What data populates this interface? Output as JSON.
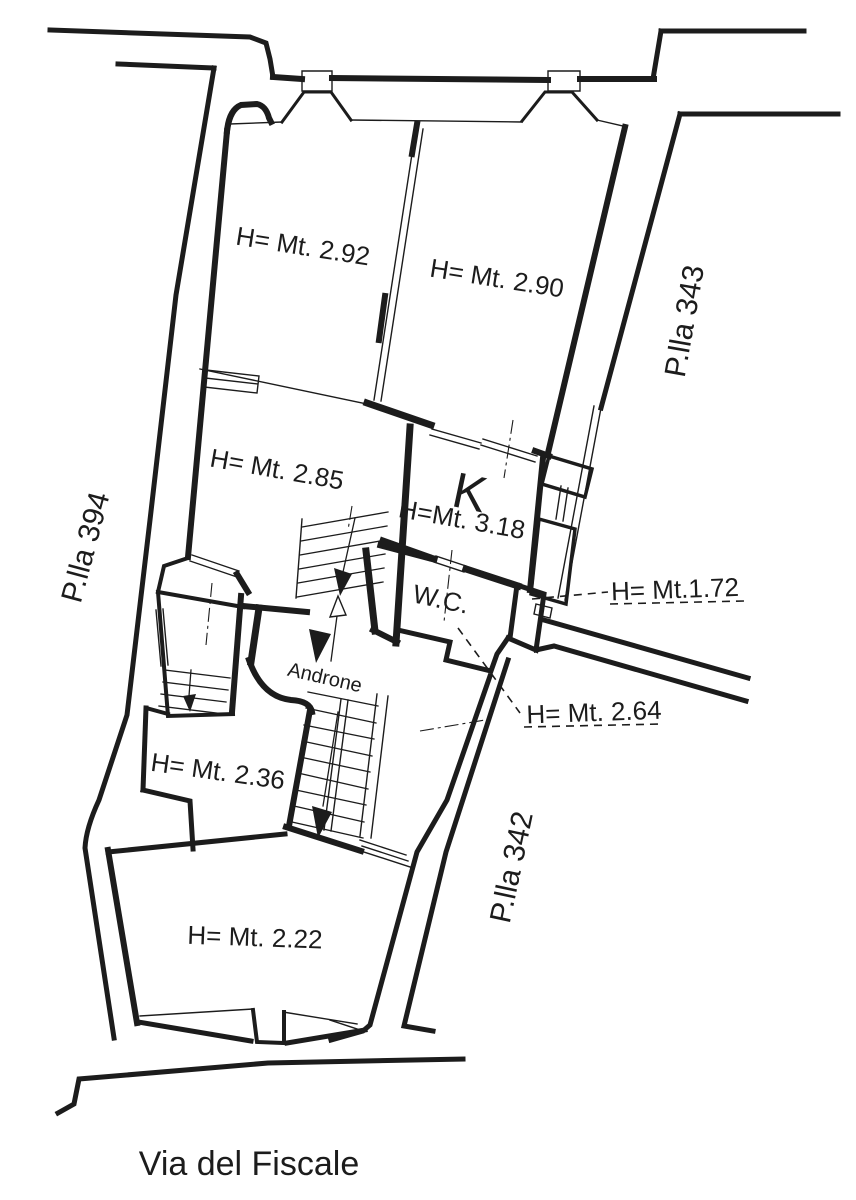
{
  "drawing": {
    "type": "cadastral floor plan",
    "street": {
      "name": "Via del Fiscale"
    },
    "parcels": {
      "p394": "P.lla 394",
      "p343": "P.lla 343",
      "p342": "P.lla 342"
    },
    "rooms": {
      "room_292": "H= Mt. 2.92",
      "room_290": "H= Mt. 2.90",
      "room_285": "H= Mt. 2.85",
      "kitchen_letter": "K",
      "kitchen_height": "H=Mt. 3.18",
      "wc": "W.C.",
      "androne": "Androne",
      "room_236": "H= Mt. 2.36",
      "room_222": "H= Mt. 2.22",
      "niche_low": "H= Mt.1.72",
      "niche_under_stair": "H= Mt. 2.64"
    },
    "colors": {
      "ink": "#1c1c1c",
      "paper": "#ffffff"
    }
  }
}
